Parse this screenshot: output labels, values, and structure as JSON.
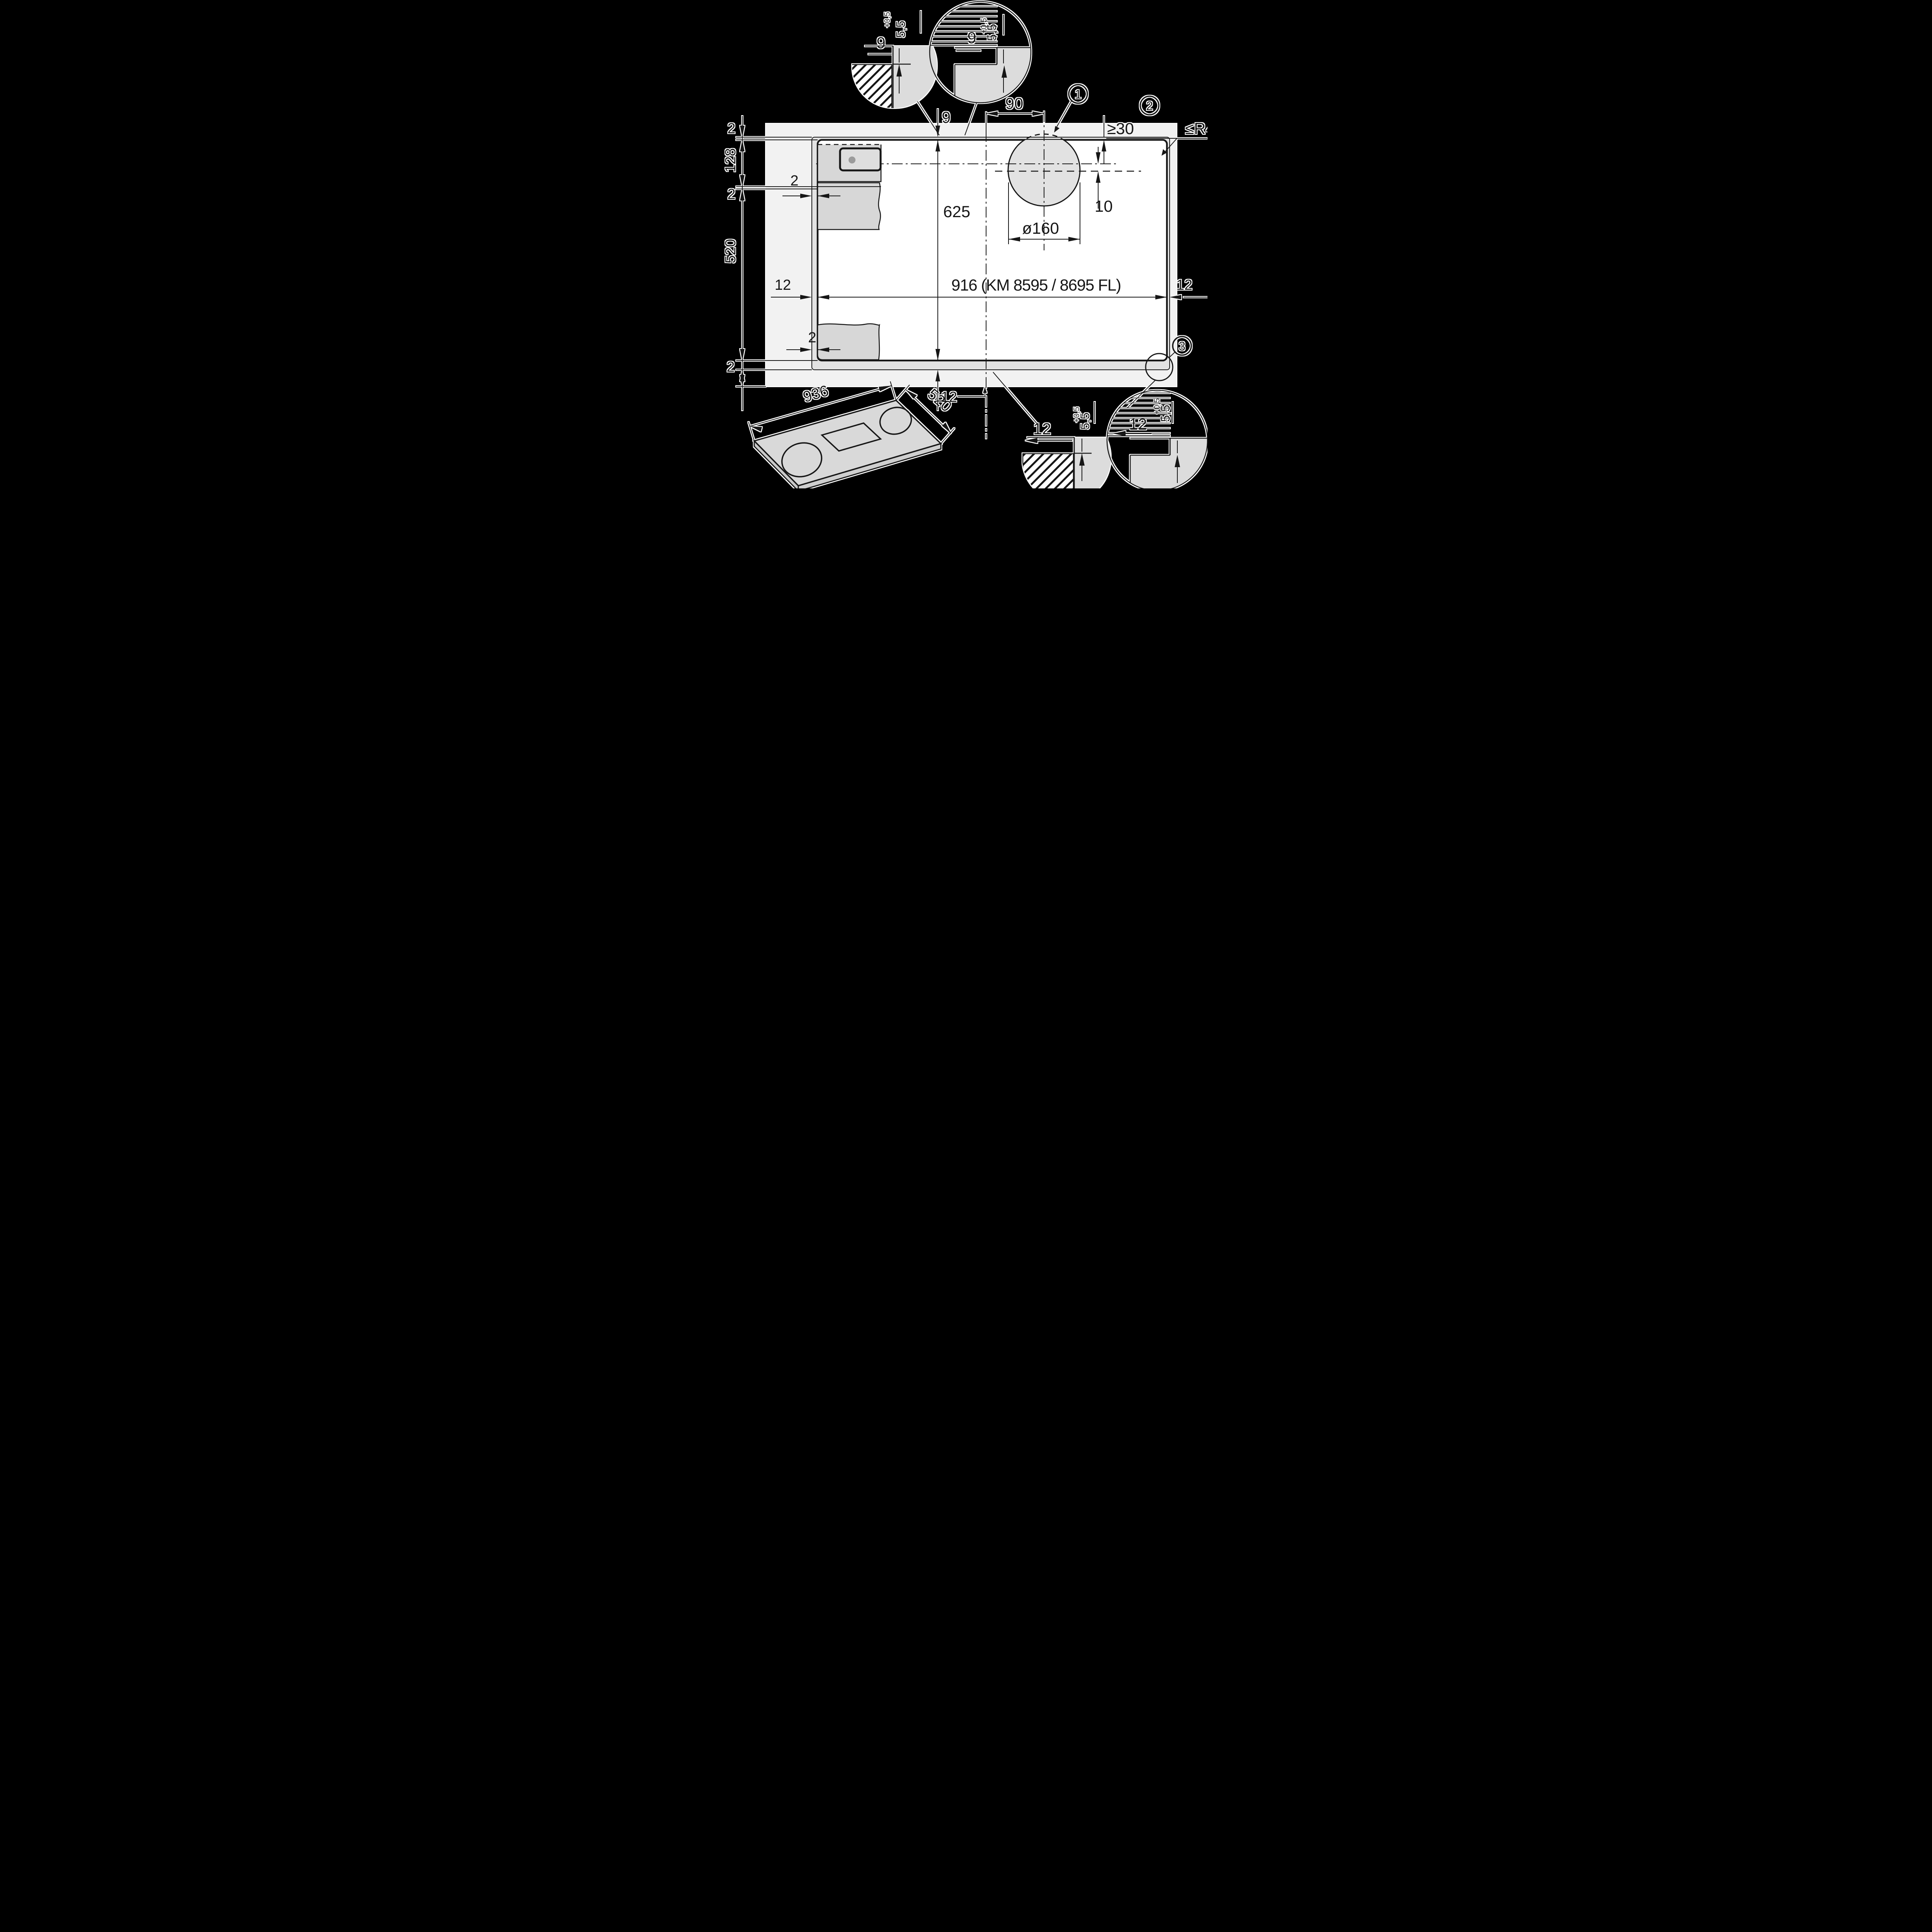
{
  "drawing": {
    "kind": "cooktop flush-installation cutout drawing",
    "background": "#000000",
    "colors": {
      "worktop": "#f2f2f2",
      "recess_band": "#e3e3e3",
      "cutout": "#ffffff",
      "glass_gray": "#dcdcdc",
      "cabinet_gray": "#d7d7d7",
      "hole_fill": "#e2e2e2",
      "line": "#161616",
      "knob_dot": "#9b9b9b",
      "hatch_dark": "#4a4a4a"
    }
  },
  "dimensions": {
    "cutout_width_label": "916 (KM 8595 / 8695 FL)",
    "cutout_depth": "625",
    "ledge_top": "9",
    "ledge_left": "12",
    "ledge_right": "12",
    "ledge_bottom": "12",
    "hole_diameter": "ø160",
    "hole_offset_horizontal": "90",
    "hole_offset_vertical": "10",
    "rear_clearance": "≥30",
    "corner_radius": "≤R4",
    "gap_upper": "2",
    "gap_lower": "2",
    "chain_top_gap": "2",
    "chain_upper_section": "128",
    "chain_mid_gap": "2",
    "chain_depth": "520",
    "chain_bottom_gap": "2",
    "appliance_width": "936",
    "appliance_depth": "520"
  },
  "callouts": {
    "one": "1",
    "two": "2",
    "three": "3"
  },
  "details": {
    "top_left": {
      "width": "9",
      "depth": "5,5",
      "tolerance": "+0,5"
    },
    "top_center": {
      "width": "9",
      "depth": "5,5",
      "tolerance": "+0,5"
    },
    "bottom_left": {
      "width": "12",
      "depth": "5,5",
      "tolerance": "+0,5"
    },
    "bottom_right": {
      "width": "12",
      "depth": "5,5",
      "tolerance": "+0,5"
    }
  }
}
